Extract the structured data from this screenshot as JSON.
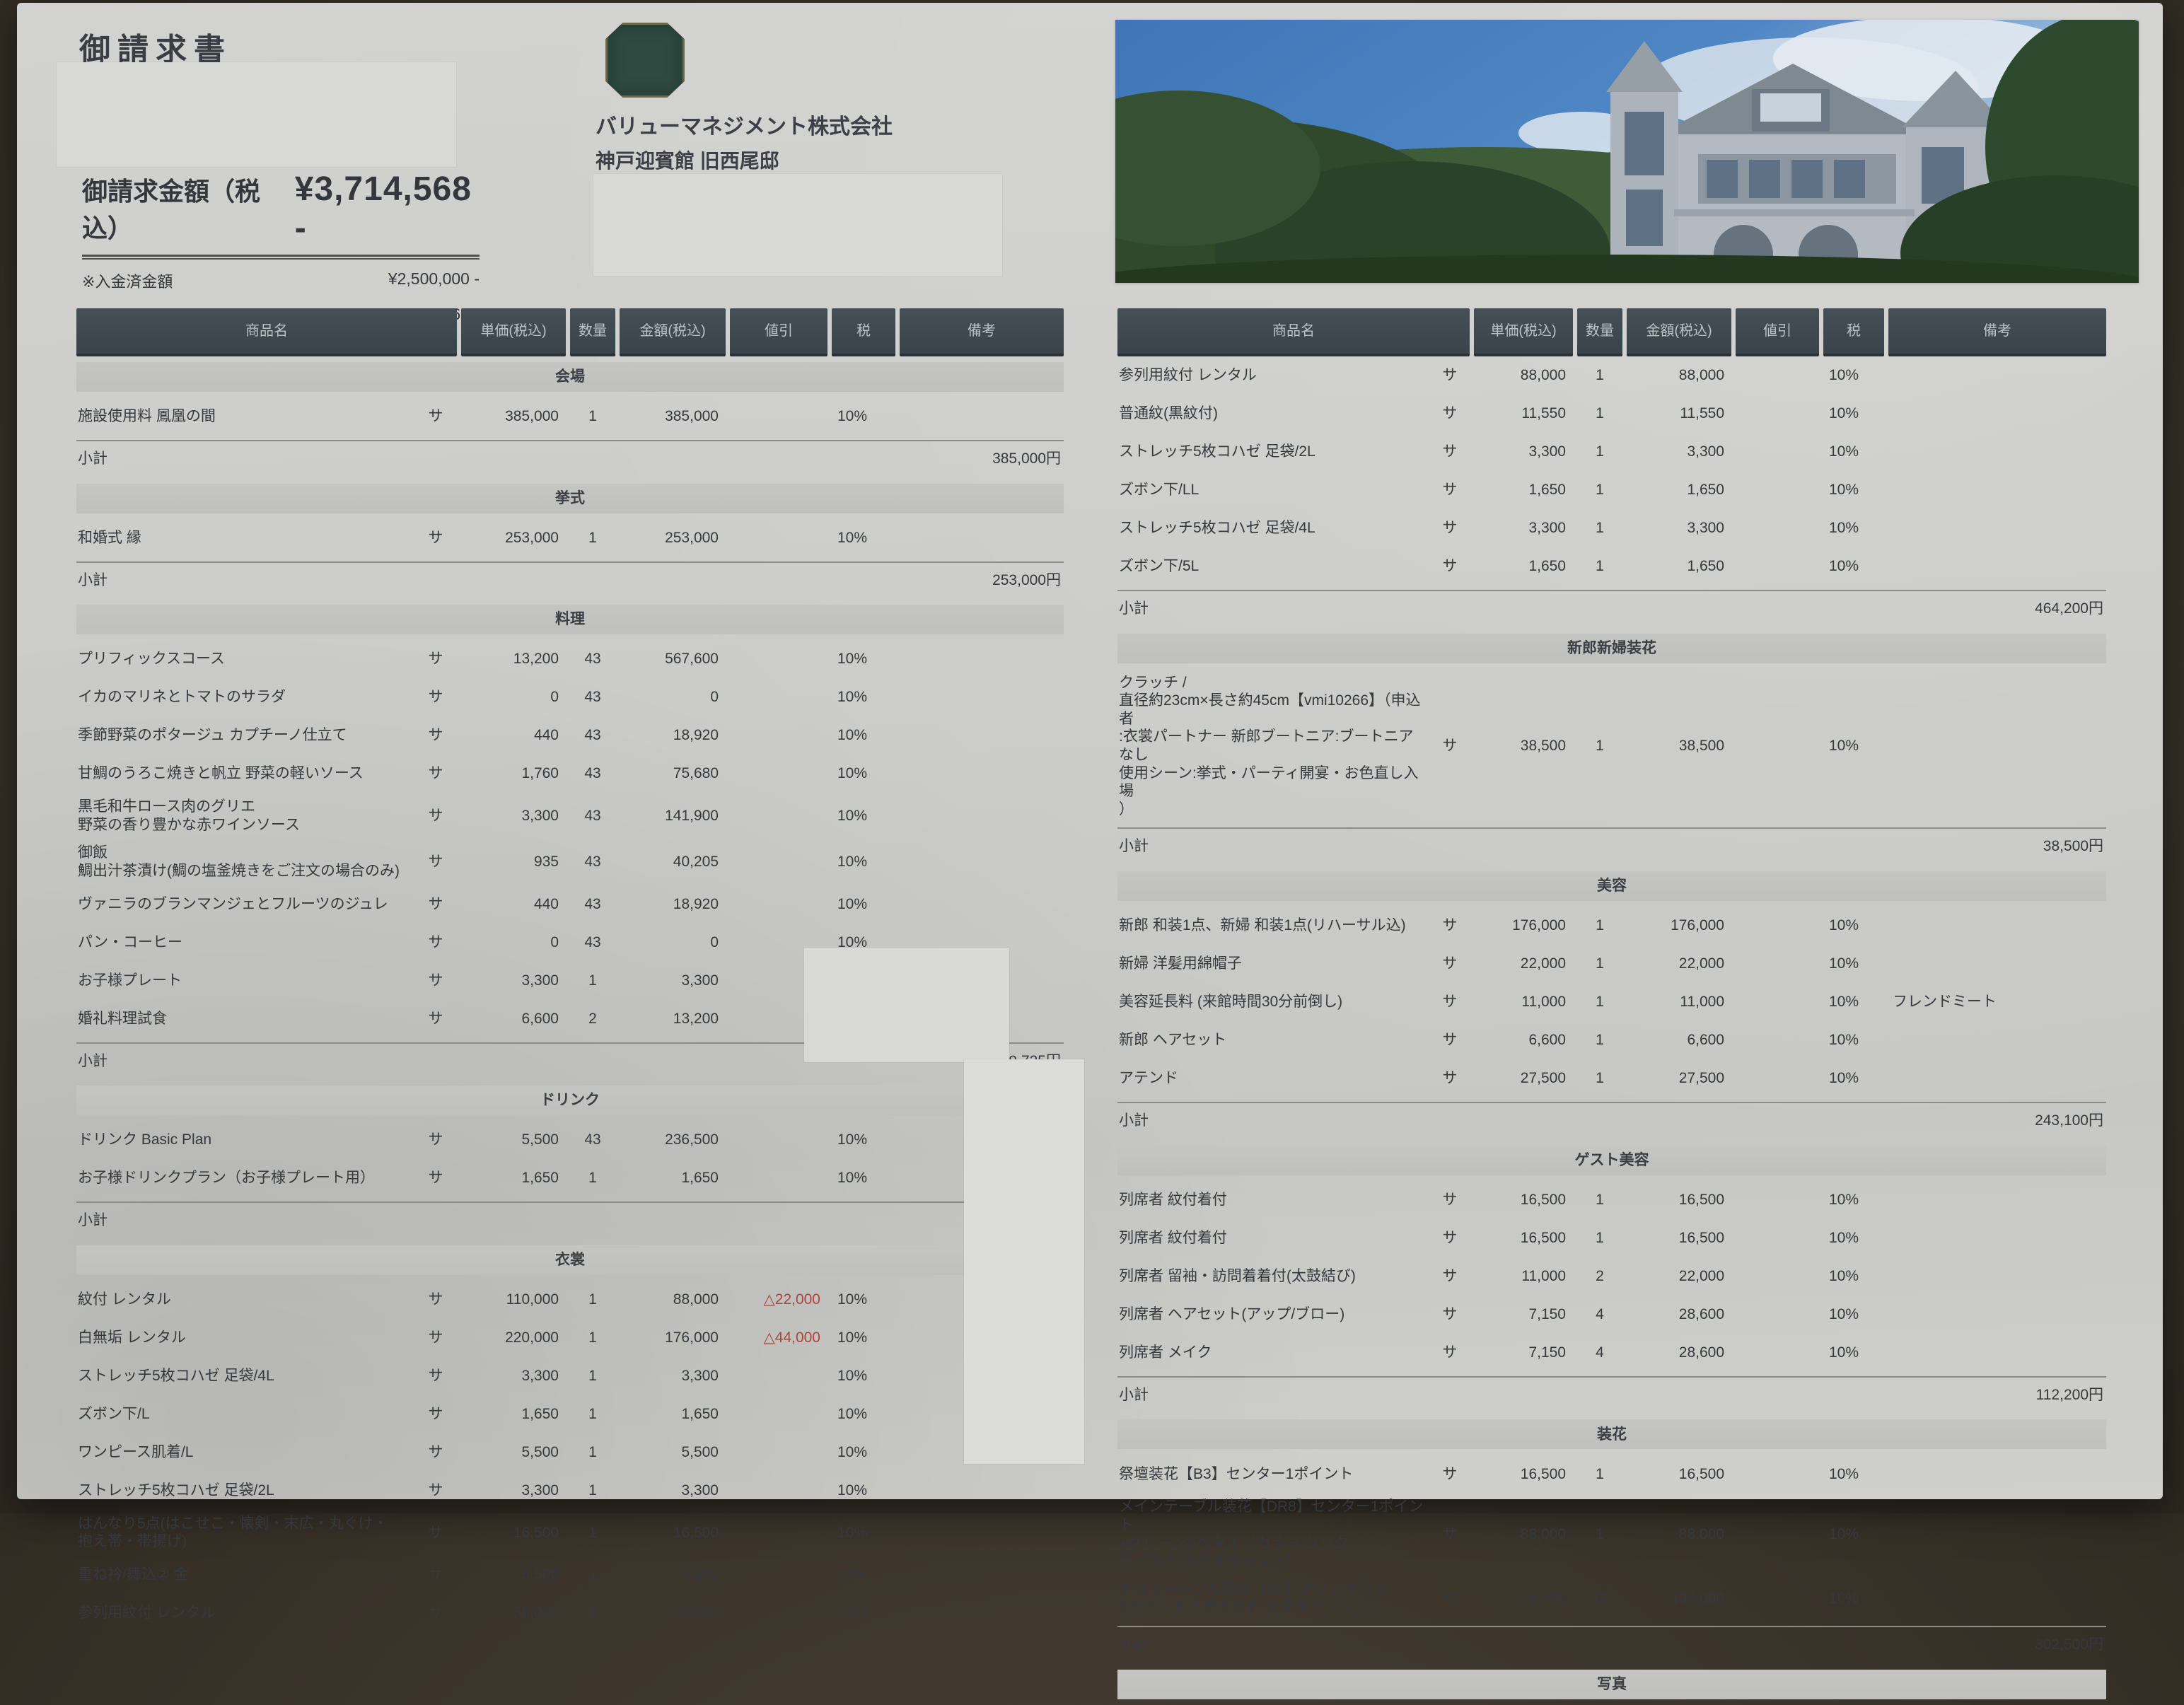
{
  "title": "御請求書",
  "billing": {
    "total_label": "御請求金額（税込）",
    "total_amount": "¥3,714,568 -",
    "paid_label": "※入金済金額",
    "paid_amount": "¥2,500,000 -",
    "balance_label": "※残金",
    "balance_amount": "¥1,214,568 -"
  },
  "issuer": {
    "company": "バリューマネジメント株式会社",
    "venue": "神戸迎賓館 旧西尾邸",
    "address": "〒654-0067 兵庫県神戸市須磨区離宮西町2丁目4-1"
  },
  "table": {
    "headers": [
      "商品名",
      "単価(税込)",
      "数量",
      "金額(税込)",
      "値引",
      "税",
      "備考"
    ],
    "service_mark": "サ",
    "subtotal_label": "小計"
  },
  "left_sections": [
    {
      "name": "会場",
      "items": [
        {
          "name": "施設使用料 鳳凰の間",
          "unit": "385,000",
          "qty": "1",
          "amount": "385,000",
          "discount": "",
          "tax": "10%",
          "note": ""
        }
      ],
      "subtotal": "385,000円"
    },
    {
      "name": "挙式",
      "items": [
        {
          "name": "和婚式 縁",
          "unit": "253,000",
          "qty": "1",
          "amount": "253,000",
          "discount": "",
          "tax": "10%",
          "note": ""
        }
      ],
      "subtotal": "253,000円"
    },
    {
      "name": "料理",
      "items": [
        {
          "name": "プリフィックスコース",
          "unit": "13,200",
          "qty": "43",
          "amount": "567,600",
          "discount": "",
          "tax": "10%",
          "note": ""
        },
        {
          "name": "イカのマリネとトマトのサラダ",
          "unit": "0",
          "qty": "43",
          "amount": "0",
          "discount": "",
          "tax": "10%",
          "note": ""
        },
        {
          "name": "季節野菜のポタージュ カプチーノ仕立て",
          "unit": "440",
          "qty": "43",
          "amount": "18,920",
          "discount": "",
          "tax": "10%",
          "note": ""
        },
        {
          "name": "甘鯛のうろこ焼きと帆立 野菜の軽いソース",
          "unit": "1,760",
          "qty": "43",
          "amount": "75,680",
          "discount": "",
          "tax": "10%",
          "note": ""
        },
        {
          "name": "黒毛和牛ロース肉のグリエ\n野菜の香り豊かな赤ワインソース",
          "unit": "3,300",
          "qty": "43",
          "amount": "141,900",
          "discount": "",
          "tax": "10%",
          "note": ""
        },
        {
          "name": "御飯\n鯛出汁茶漬け(鯛の塩釜焼きをご注文の場合のみ)",
          "unit": "935",
          "qty": "43",
          "amount": "40,205",
          "discount": "",
          "tax": "10%",
          "note": ""
        },
        {
          "name": "ヴァニラのブランマンジェとフルーツのジュレ",
          "unit": "440",
          "qty": "43",
          "amount": "18,920",
          "discount": "",
          "tax": "10%",
          "note": ""
        },
        {
          "name": "パン・コーヒー",
          "unit": "0",
          "qty": "43",
          "amount": "0",
          "discount": "",
          "tax": "10%",
          "note": ""
        },
        {
          "name": "お子様プレート",
          "unit": "3,300",
          "qty": "1",
          "amount": "3,300",
          "discount": "",
          "tax": "10%",
          "note": ""
        },
        {
          "name": "婚礼料理試食",
          "unit": "6,600",
          "qty": "2",
          "amount": "13,200",
          "discount": "",
          "tax": "10%",
          "note": ""
        }
      ],
      "subtotal": "879,725円"
    },
    {
      "name": "ドリンク",
      "items": [
        {
          "name": "ドリンク Basic Plan",
          "unit": "5,500",
          "qty": "43",
          "amount": "236,500",
          "discount": "",
          "tax": "10%",
          "note": ""
        },
        {
          "name": "お子様ドリンクプラン（お子様プレート用）",
          "unit": "1,650",
          "qty": "1",
          "amount": "1,650",
          "discount": "",
          "tax": "10%",
          "note": ""
        }
      ],
      "subtotal": "238,150円"
    },
    {
      "name": "衣裳",
      "items": [
        {
          "name": "紋付  レンタル",
          "unit": "110,000",
          "qty": "1",
          "amount": "88,000",
          "discount": "△22,000",
          "tax": "10%",
          "note": ""
        },
        {
          "name": "白無垢  レンタル",
          "unit": "220,000",
          "qty": "1",
          "amount": "176,000",
          "discount": "△44,000",
          "tax": "10%",
          "note": ""
        },
        {
          "name": "ストレッチ5枚コハゼ 足袋/4L",
          "unit": "3,300",
          "qty": "1",
          "amount": "3,300",
          "discount": "",
          "tax": "10%",
          "note": ""
        },
        {
          "name": "ズボン下/L",
          "unit": "1,650",
          "qty": "1",
          "amount": "1,650",
          "discount": "",
          "tax": "10%",
          "note": ""
        },
        {
          "name": "ワンピース肌着/L",
          "unit": "5,500",
          "qty": "1",
          "amount": "5,500",
          "discount": "",
          "tax": "10%",
          "note": ""
        },
        {
          "name": "ストレッチ5枚コハゼ 足袋/2L",
          "unit": "3,300",
          "qty": "1",
          "amount": "3,300",
          "discount": "",
          "tax": "10%",
          "note": ""
        },
        {
          "name": "はんなり5点(はこせこ・懐剣・末広・丸ぐけ・\n抱え帯・帯揚げ)",
          "unit": "16,500",
          "qty": "1",
          "amount": "16,500",
          "discount": "",
          "tax": "10%",
          "note": ""
        },
        {
          "name": "重ね衿/舞込②  金",
          "unit": "5,500",
          "qty": "1",
          "amount": "5,500",
          "discount": "",
          "tax": "10%",
          "note": ""
        },
        {
          "name": "参列用紋付  レンタル",
          "unit": "55,000",
          "qty": "1",
          "amount": "55,000",
          "discount": "",
          "tax": "10%",
          "note": ""
        }
      ],
      "subtotal": null
    }
  ],
  "right_sections": [
    {
      "name": "",
      "items": [
        {
          "name": "参列用紋付  レンタル",
          "unit": "88,000",
          "qty": "1",
          "amount": "88,000",
          "discount": "",
          "tax": "10%",
          "note": ""
        },
        {
          "name": "普通紋(黒紋付)",
          "unit": "11,550",
          "qty": "1",
          "amount": "11,550",
          "discount": "",
          "tax": "10%",
          "note": ""
        },
        {
          "name": "ストレッチ5枚コハゼ 足袋/2L",
          "unit": "3,300",
          "qty": "1",
          "amount": "3,300",
          "discount": "",
          "tax": "10%",
          "note": ""
        },
        {
          "name": "ズボン下/LL",
          "unit": "1,650",
          "qty": "1",
          "amount": "1,650",
          "discount": "",
          "tax": "10%",
          "note": ""
        },
        {
          "name": "ストレッチ5枚コハゼ 足袋/4L",
          "unit": "3,300",
          "qty": "1",
          "amount": "3,300",
          "discount": "",
          "tax": "10%",
          "note": ""
        },
        {
          "name": "ズボン下/5L",
          "unit": "1,650",
          "qty": "1",
          "amount": "1,650",
          "discount": "",
          "tax": "10%",
          "note": ""
        }
      ],
      "subtotal": "464,200円"
    },
    {
      "name": "新郎新婦装花",
      "items": [
        {
          "name": "クラッチ /\n直径約23cm×長さ約45cm【vmi10266】（申込者\n:衣裳パートナー 新郎ブートニア:ブートニアなし\n使用シーン:挙式・パーティ開宴・お色直し入場\n）",
          "unit": "38,500",
          "qty": "1",
          "amount": "38,500",
          "discount": "",
          "tax": "10%",
          "note": ""
        }
      ],
      "subtotal": "38,500円"
    },
    {
      "name": "美容",
      "items": [
        {
          "name": "新郎 和装1点、新婦 和装1点(リハーサル込)",
          "unit": "176,000",
          "qty": "1",
          "amount": "176,000",
          "discount": "",
          "tax": "10%",
          "note": ""
        },
        {
          "name": "新婦 洋髪用綿帽子",
          "unit": "22,000",
          "qty": "1",
          "amount": "22,000",
          "discount": "",
          "tax": "10%",
          "note": ""
        },
        {
          "name": "美容延長料 (来館時間30分前倒し)",
          "unit": "11,000",
          "qty": "1",
          "amount": "11,000",
          "discount": "",
          "tax": "10%",
          "note": "フレンドミート"
        },
        {
          "name": "新郎 ヘアセット",
          "unit": "6,600",
          "qty": "1",
          "amount": "6,600",
          "discount": "",
          "tax": "10%",
          "note": ""
        },
        {
          "name": "アテンド",
          "unit": "27,500",
          "qty": "1",
          "amount": "27,500",
          "discount": "",
          "tax": "10%",
          "note": ""
        }
      ],
      "subtotal": "243,100円"
    },
    {
      "name": "ゲスト美容",
      "items": [
        {
          "name": "列席者 紋付着付",
          "unit": "16,500",
          "qty": "1",
          "amount": "16,500",
          "discount": "",
          "tax": "10%",
          "note": ""
        },
        {
          "name": "列席者 紋付着付",
          "unit": "16,500",
          "qty": "1",
          "amount": "16,500",
          "discount": "",
          "tax": "10%",
          "note": ""
        },
        {
          "name": "列席者 留袖・訪問着着付(太鼓結び)",
          "unit": "11,000",
          "qty": "2",
          "amount": "22,000",
          "discount": "",
          "tax": "10%",
          "note": ""
        },
        {
          "name": "列席者 ヘアセット(アップ/ブロー)",
          "unit": "7,150",
          "qty": "4",
          "amount": "28,600",
          "discount": "",
          "tax": "10%",
          "note": ""
        },
        {
          "name": "列席者 メイク",
          "unit": "7,150",
          "qty": "4",
          "amount": "28,600",
          "discount": "",
          "tax": "10%",
          "note": ""
        }
      ],
      "subtotal": "112,200円"
    },
    {
      "name": "装花",
      "items": [
        {
          "name": "祭壇装花【B3】センター1ポイント",
          "unit": "16,500",
          "qty": "1",
          "amount": "16,500",
          "discount": "",
          "tax": "10%",
          "note": ""
        },
        {
          "name": "メインテーブル装花【DR8】センター1ポイント\n+グリーン&ペタル（カラー:シック\nテイスト:スタイリッシュ）",
          "unit": "88,000",
          "qty": "1",
          "amount": "88,000",
          "discount": "",
          "tax": "10%",
          "note": ""
        },
        {
          "name": "ゲストテーブル装花【F5】クリアグラス\n3ポイント（テイスト:スタイリッシュ）",
          "unit": "16,500",
          "qty": "12",
          "amount": "198,000",
          "discount": "",
          "tax": "10%",
          "note": ""
        }
      ],
      "subtotal": "302,500円"
    },
    {
      "name": "写真",
      "items": [],
      "subtotal": null
    }
  ]
}
